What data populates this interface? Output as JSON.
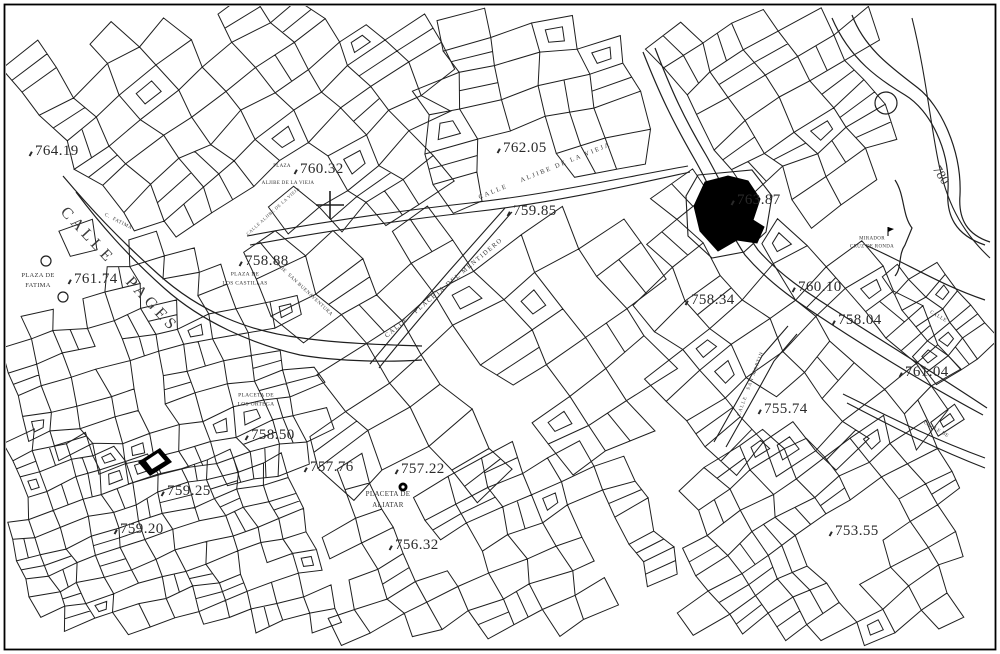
{
  "colors": {
    "background": "#ffffff",
    "line": "#1f1f1f",
    "label": "#2a2a2a",
    "landmark_fill": "#000000"
  },
  "labels": {
    "elevations": [
      {
        "value": "764.19",
        "x": 28,
        "y": 143
      },
      {
        "value": "760.32",
        "x": 293,
        "y": 161
      },
      {
        "value": "762.05",
        "x": 496,
        "y": 140
      },
      {
        "value": "759.85",
        "x": 506,
        "y": 203
      },
      {
        "value": "763.87",
        "x": 730,
        "y": 192
      },
      {
        "value": "758.88",
        "x": 238,
        "y": 253
      },
      {
        "value": "761.74",
        "x": 67,
        "y": 271
      },
      {
        "value": "758.34",
        "x": 684,
        "y": 292
      },
      {
        "value": "760.10",
        "x": 791,
        "y": 279
      },
      {
        "value": "758.04",
        "x": 831,
        "y": 312
      },
      {
        "value": "761.04",
        "x": 898,
        "y": 364
      },
      {
        "value": "755.74",
        "x": 757,
        "y": 401
      },
      {
        "value": "758.50",
        "x": 244,
        "y": 427
      },
      {
        "value": "757.76",
        "x": 303,
        "y": 459
      },
      {
        "value": "757.22",
        "x": 394,
        "y": 461
      },
      {
        "value": "759.25",
        "x": 160,
        "y": 483
      },
      {
        "value": "759.20",
        "x": 113,
        "y": 521
      },
      {
        "value": "756.32",
        "x": 388,
        "y": 537
      },
      {
        "value": "753.55",
        "x": 828,
        "y": 523
      }
    ],
    "places": [
      {
        "lines": [
          "PLAZA DE",
          "FATIMA"
        ],
        "x": 38,
        "y": 281,
        "size": 6.5
      },
      {
        "lines": [
          "PLAZA"
        ],
        "x": 282,
        "y": 167,
        "size": 5
      },
      {
        "lines": [
          "ALJIBE DE LA VIEJA"
        ],
        "x": 288,
        "y": 184,
        "size": 5
      },
      {
        "lines": [
          "PLAZA DE",
          "LOS CASTILLAS"
        ],
        "x": 245,
        "y": 279,
        "size": 5.5
      },
      {
        "lines": [
          "PLACETA DE",
          "LOS ORTEGA"
        ],
        "x": 256,
        "y": 400,
        "size": 5.5
      },
      {
        "lines": [
          "PLACETA DE",
          "ALIATAR"
        ],
        "x": 388,
        "y": 500,
        "size": 7
      },
      {
        "lines": [
          "MIRADOR",
          "CRUZ DE RONDA"
        ],
        "x": 872,
        "y": 243,
        "size": 5
      }
    ],
    "streets": [
      {
        "text": "CALLE   PAGES",
        "x": 119,
        "y": 270,
        "rot": 47,
        "size": 16,
        "ls": 4
      },
      {
        "text": "CALLE    ALJIBE DE LA VIEJA",
        "x": 545,
        "y": 171,
        "rot": -22,
        "size": 6.5,
        "ls": 2
      },
      {
        "text": "CALLE ALJIBE DE LA VIEJA",
        "x": 273,
        "y": 211,
        "rot": -42,
        "size": 4.5,
        "ls": 0.5
      },
      {
        "text": "CALLE   PLACETA DEL MENTIDERO",
        "x": 444,
        "y": 288,
        "rot": -40,
        "size": 6.5,
        "ls": 1.5
      },
      {
        "text": "C. DE  SAN BUENAVENTURA",
        "x": 303,
        "y": 289,
        "rot": 43,
        "size": 5,
        "ls": 0.5
      },
      {
        "text": "C.  FATIMA",
        "x": 118,
        "y": 222,
        "rot": 27,
        "size": 5,
        "ls": 0.5
      },
      {
        "text": "CALLE   SAN MARTIN",
        "x": 751,
        "y": 384,
        "rot": -70,
        "size": 5,
        "ls": 1
      },
      {
        "text": "CALLE",
        "x": 938,
        "y": 317,
        "rot": 30,
        "size": 5,
        "ls": 0.5
      },
      {
        "text": "CALLE DE",
        "x": 936,
        "y": 430,
        "rot": 30,
        "size": 5,
        "ls": 0.5
      }
    ],
    "contours": [
      {
        "text": "780",
        "x": 941,
        "y": 175,
        "rot": 58,
        "size": 13
      }
    ]
  }
}
